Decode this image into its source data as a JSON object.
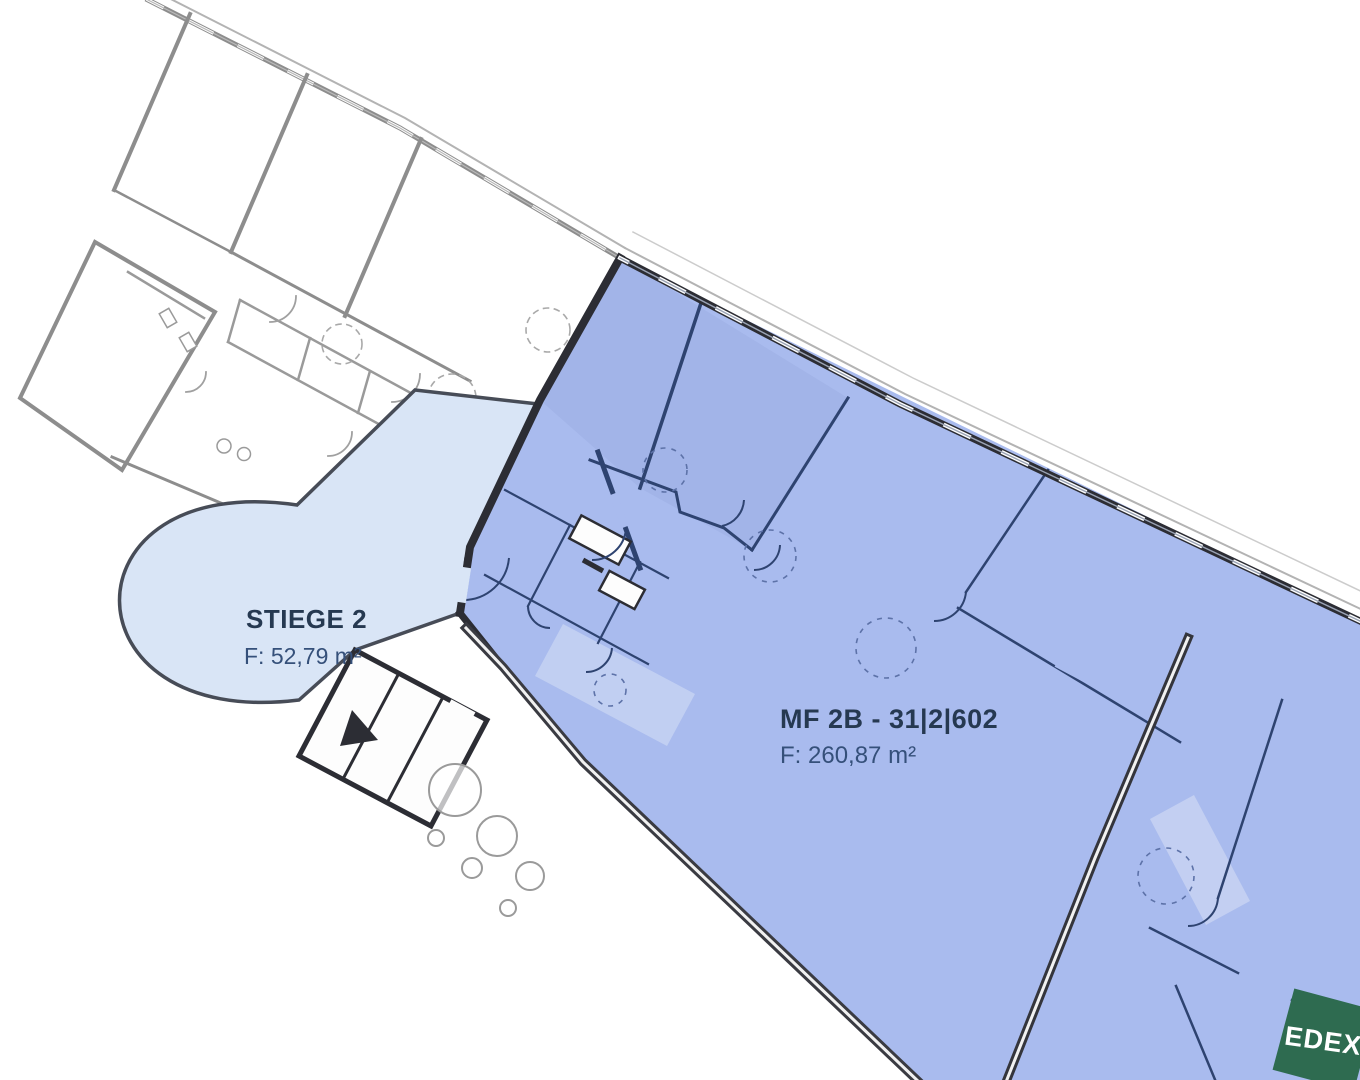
{
  "plan": {
    "stairwell": {
      "title": "STIEGE 2",
      "area": "F: 52,79 m²"
    },
    "unit": {
      "title": "MF 2B - 31|2|602",
      "area": "F: 260,87 m²"
    }
  },
  "logo": {
    "text": "EDEX",
    "color": "#2E6B50"
  },
  "colors": {
    "unit_fill": "#A9BBEE",
    "stairwell_fill": "#D9E5F6",
    "wall_dark": "#2C2D34",
    "partition_navy": "#2E4370",
    "neighbor_gray": "#8D8D8D",
    "title_text": "#263951",
    "area_text": "#35507A"
  }
}
